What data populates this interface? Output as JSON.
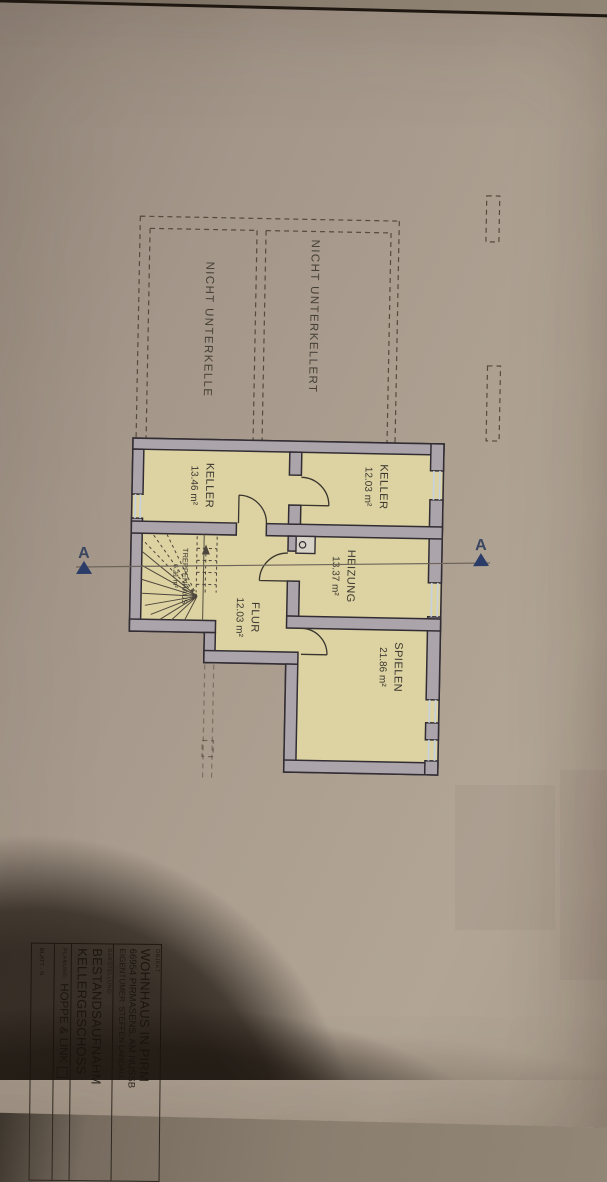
{
  "plan": {
    "section_marker": "A",
    "rooms": [
      {
        "name": "KELLER",
        "area": "12.03 m²"
      },
      {
        "name": "KELLER",
        "area": "13.46 m²"
      },
      {
        "name": "HEIZUNG",
        "area": "13.37 m²"
      },
      {
        "name": "FLUR",
        "area": "12.03 m²"
      },
      {
        "name": "SPIELEN",
        "area": "21.86 m²"
      },
      {
        "name": "TREPPENHAUS",
        "area": "6.21 m²"
      }
    ],
    "annotations": [
      {
        "label": "NICHT UNTERKELLERT"
      },
      {
        "label": "NICHT UNTERKELLE"
      }
    ],
    "colors": {
      "room_fill": "#dcd2a2",
      "wall_fill": "#aca4ab",
      "outline": "#312d33",
      "window": "#c6d2de",
      "marker_blue": "#2b3c68",
      "paper": "#a79a8a"
    }
  },
  "title_block": {
    "object_label": "OBJEKT",
    "object_lines": {
      "0": "WOHNHAUS IN PIRM",
      "1": "66954 PIRMASENS, AM NUSSB",
      "2": "EIGENTÜMER: STEFFEN LANDAU,"
    },
    "darstellung_label": "DARSTELLUNG:",
    "darstellung_lines": {
      "0": "BESTANDSAUFNAHM",
      "1": "KELLERGESCHOSS"
    },
    "planung_label": "PLANUNG:",
    "planung_firm": "HOPPE & LINK",
    "blatt_label": "BLATT - N"
  }
}
